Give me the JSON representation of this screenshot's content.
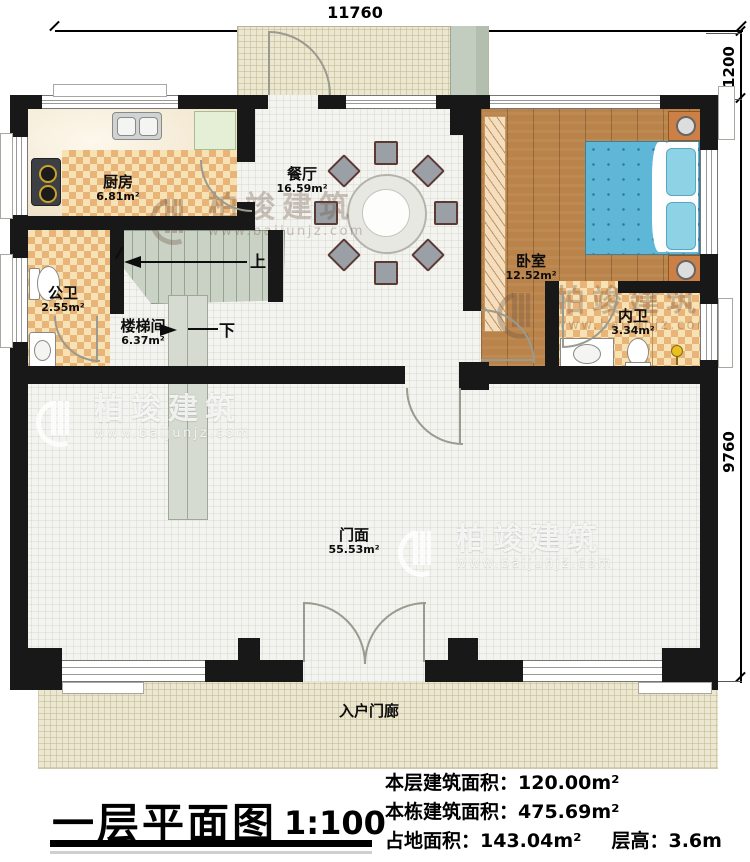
{
  "dimensions": {
    "top": "11760",
    "right_upper": "1200",
    "right_lower": "9760"
  },
  "rooms": {
    "kitchen": {
      "name": "厨房",
      "area": "6.81m²"
    },
    "dining": {
      "name": "餐厅",
      "area": "16.59m²"
    },
    "bedroom": {
      "name": "卧室",
      "area": "12.52m²"
    },
    "public_bath": {
      "name": "公卫",
      "area": "2.55m²"
    },
    "stairwell": {
      "name": "楼梯间",
      "area": "6.37m²"
    },
    "private_bath": {
      "name": "内卫",
      "area": "3.34m²"
    },
    "storefront": {
      "name": "门面",
      "area": "55.53m²"
    },
    "entry_porch": {
      "name": "入户门廊"
    }
  },
  "stairs": {
    "up": "上",
    "down": "下"
  },
  "title_block": {
    "title": "一层平面图",
    "scale": "1:100",
    "stats": [
      {
        "label": "本层建筑面积：",
        "value": "120.00m²"
      },
      {
        "label": "本栋建筑面积：",
        "value": "475.69m²"
      },
      {
        "label": "占地面积：",
        "value": "143.04m²",
        "label2": "层高：",
        "value2": "3.6m"
      }
    ]
  },
  "watermark": {
    "brand": "柏竣建筑",
    "url": "www.baijunjz.com"
  },
  "colors": {
    "wall": "#181818",
    "checker_floor": "#e9b477",
    "wood_floor": "#b9834a",
    "bed": "#5fb7d8",
    "stairs": "#c9d2c4",
    "porch": "#ece7d0"
  }
}
